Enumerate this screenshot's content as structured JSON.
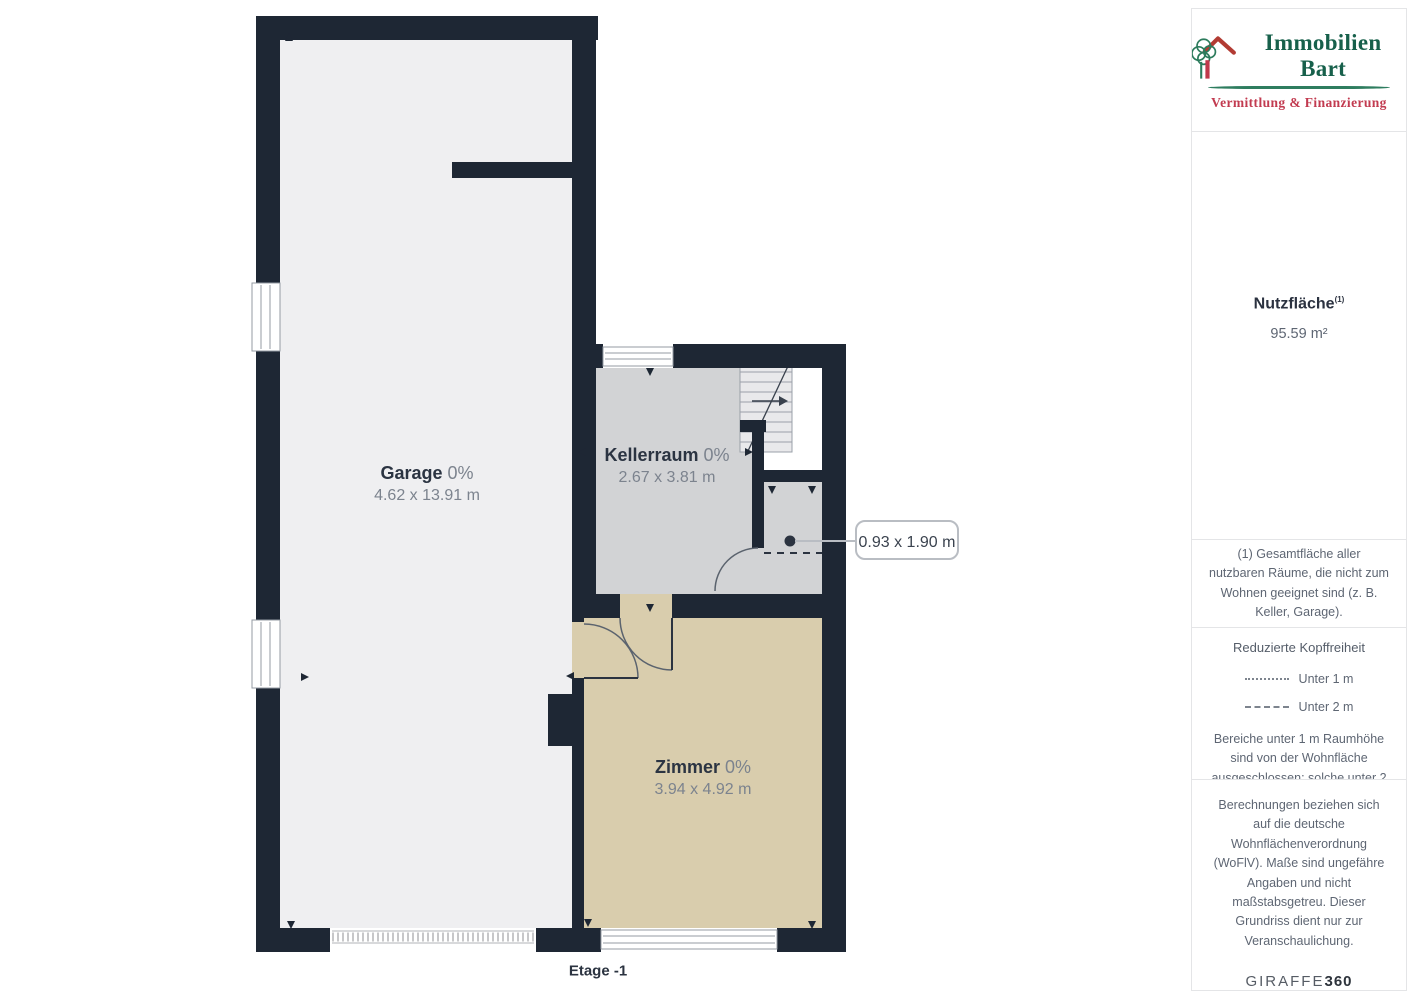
{
  "branding": {
    "name": "Immobilien Bart",
    "tagline": "Vermittlung & Finanzierung"
  },
  "floorplan": {
    "floor_label": "Etage -1",
    "rooms": [
      {
        "name": "Garage",
        "percent": "0%",
        "dimensions": "4.62 x 13.91 m"
      },
      {
        "name": "Kellerraum",
        "percent": "0%",
        "dimensions": "2.67 x 3.81 m"
      },
      {
        "name": "Zimmer",
        "percent": "0%",
        "dimensions": "3.94 x 4.92 m"
      }
    ],
    "callout": {
      "label": "0.93 x 1.90 m"
    },
    "colors": {
      "wall": "#1e2734",
      "garage_floor": "#efeff1",
      "keller_floor": "#d2d3d5",
      "zimmer_floor": "#d9cdad",
      "logo_green": "#17604b",
      "logo_red": "#c23b50"
    }
  },
  "sidebar": {
    "area_label": "Nutzfläche",
    "area_footnote_mark": "(1)",
    "area_value": "95.59 m²",
    "footnote": "(1) Gesamtfläche aller nutzbaren Räume, die nicht zum Wohnen geeignet sind (z. B. Keller, Garage).",
    "headroom": {
      "title": "Reduzierte Kopffreiheit",
      "legend": [
        {
          "style": "dotted",
          "label": "Unter 1 m"
        },
        {
          "style": "dashed",
          "label": "Unter 2 m"
        }
      ],
      "note": "Bereiche unter 1 m Raumhöhe sind von der Wohnfläche ausgeschlossen; solche unter 2 m, aber über 1 m, zählen als 50% der Wohnfläche"
    },
    "disclaimer": "Berechnungen beziehen sich auf die deutsche Wohnflächenverordnung (WoFlV). Maße sind ungefähre Angaben und nicht maßstabsgetreu. Dieser Grundriss dient nur zur Veranschaulichung.",
    "provider": {
      "name": "GIRAFFE",
      "suffix": "360"
    }
  }
}
